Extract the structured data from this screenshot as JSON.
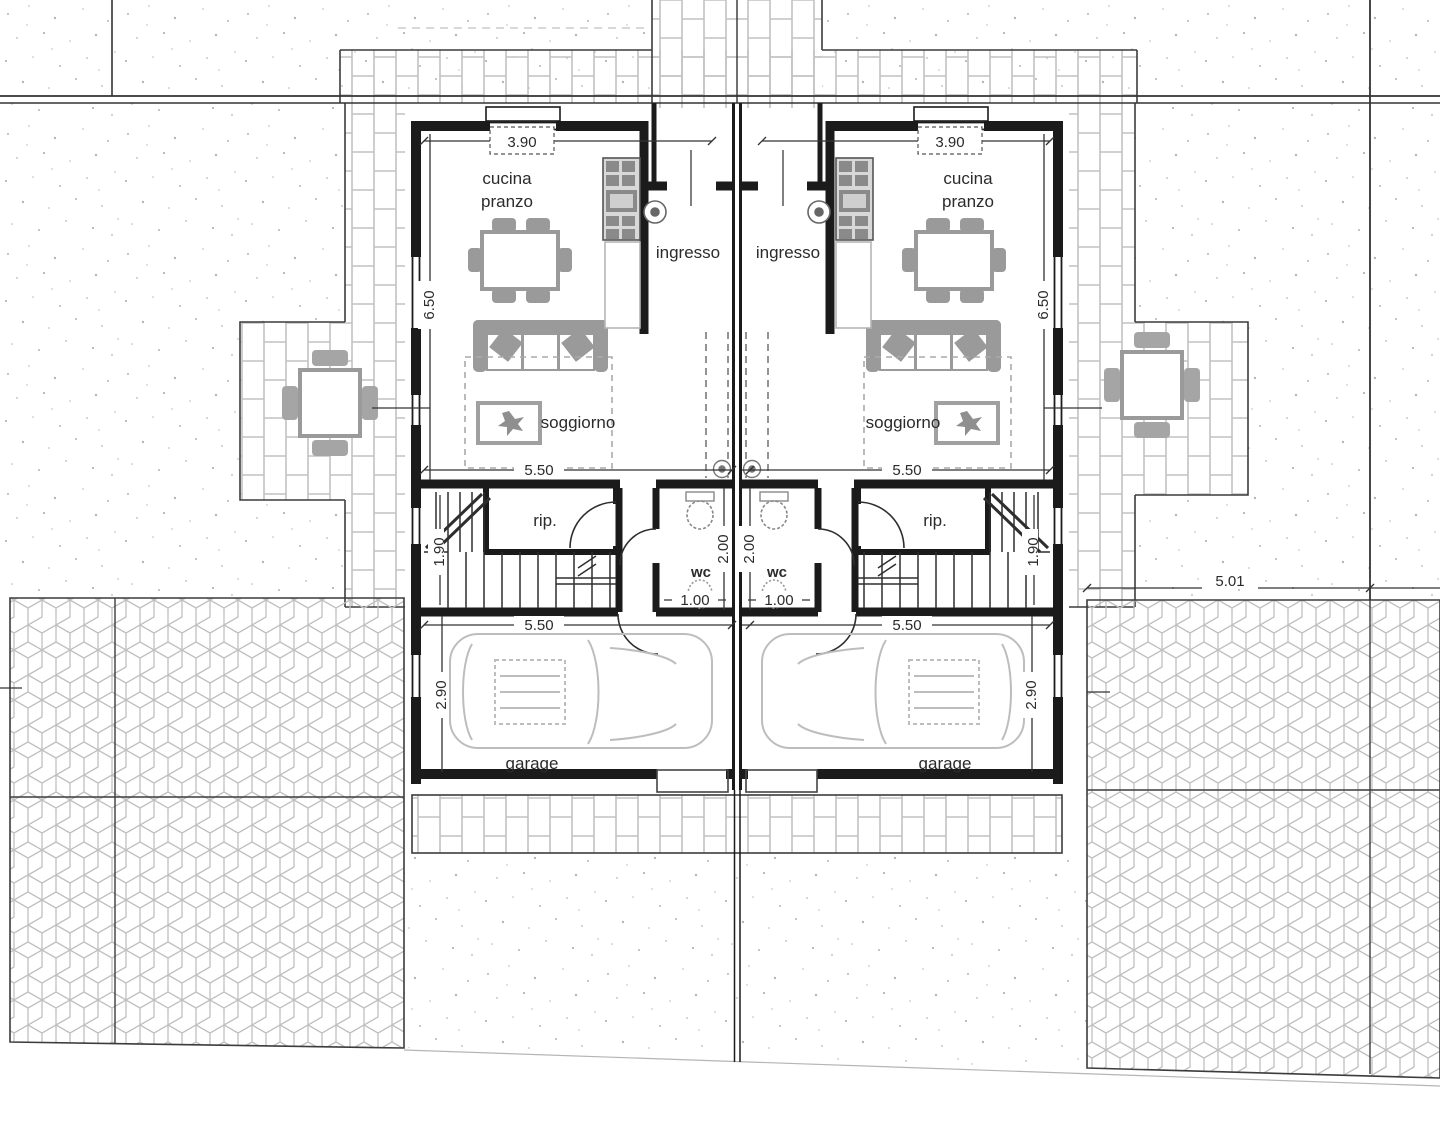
{
  "colors": {
    "wall": "#1b1b1b",
    "thin_line": "#3c3c3c",
    "furniture_gray": "#8f8f8f",
    "paving_gray": "#c6c6c6",
    "text": "#2b2b2b"
  },
  "left_unit": {
    "kitchen_label_line1": "cucina",
    "kitchen_label_line2": "pranzo",
    "entrance_label": "ingresso",
    "living_label": "soggiorno",
    "storage_label": "rip.",
    "wc_label": "wc",
    "garage_label": "garage",
    "dim_top_width": "3.90",
    "dim_side_height": "6.50",
    "dim_living_width": "5.50",
    "dim_stair_depth": "1.90",
    "dim_wc_depth": "2.00",
    "dim_wc_width": "1.00",
    "dim_garage_width": "5.50",
    "dim_garage_height": "2.90"
  },
  "right_unit": {
    "kitchen_label_line1": "cucina",
    "kitchen_label_line2": "pranzo",
    "entrance_label": "ingresso",
    "living_label": "soggiorno",
    "storage_label": "rip.",
    "wc_label": "wc",
    "garage_label": "garage",
    "dim_top_width": "3.90",
    "dim_side_height": "6.50",
    "dim_living_width": "5.50",
    "dim_stair_depth": "1.90",
    "dim_wc_depth": "2.00",
    "dim_wc_width": "1.00",
    "dim_garage_width": "5.50",
    "dim_garage_height": "2.90"
  },
  "site": {
    "dim_side_offset": "5.01"
  }
}
